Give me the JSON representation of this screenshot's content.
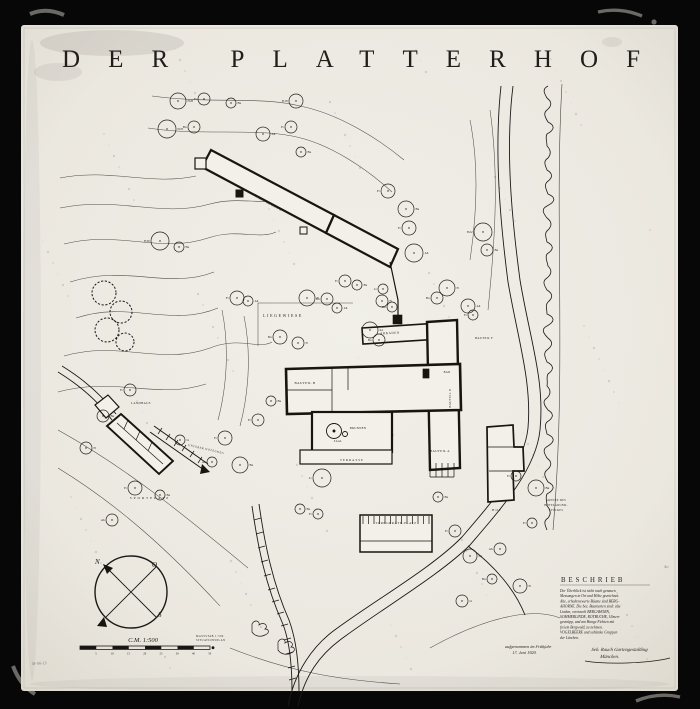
{
  "artwork": {
    "title": "DER PLATTERHOF",
    "corner_mark": "M-06-13",
    "plate_mark": "4a"
  },
  "compass": {
    "letters": {
      "n": "N",
      "o": "O",
      "s": "S"
    }
  },
  "scale_bar": {
    "label": "C.M. 1:500",
    "ticks": [
      "5",
      "10",
      "15",
      "20",
      "25",
      "30",
      "40",
      "50"
    ]
  },
  "beschrieb": {
    "heading": "BESCHRIEB",
    "lines": [
      "Der Überblick ist nicht nach genauen",
      "Messungen in Ort und Höhe gezeichnet.",
      "Alte, erhaltenswerte Bäume sind BERG-",
      "AHORNE. Die bez. Baumarten sind: alte",
      "Linden, vereinzelt BERGAHORN,",
      "SOMMERLINDE, ROTBUCHE, Ulmen-",
      "gestrüpp, und am Hange Fichten mit",
      "freiem Bergwald, zu nehmen.",
      "VOGELBEERE und schlanke Gruppen",
      "der Lärchen."
    ]
  },
  "notes": {
    "legend_small_lines": [
      "MASSSTAB 1:500",
      "SITUATIONSPLAN"
    ],
    "survey_note_lines": [
      "aufgenommen im Frühjahr",
      "17. Juni 1920."
    ],
    "signature_lines": [
      "Seb. Rauch Gartengestaltung",
      "München."
    ]
  },
  "plan_labels": [
    {
      "text": "LIEGEWIESE",
      "x": 283,
      "y": 317,
      "size": 4.0,
      "rot": 0,
      "ls": 1.6
    },
    {
      "text": "ARKADEN",
      "x": 390,
      "y": 334,
      "size": 3.2,
      "rot": -2,
      "ls": 0.6
    },
    {
      "text": "BAUTEIL B",
      "x": 305,
      "y": 384,
      "size": 3.4,
      "rot": 0,
      "ls": 0.4
    },
    {
      "text": "BAUTEIL A",
      "x": 440,
      "y": 452,
      "size": 3.2,
      "rot": 0,
      "ls": 0.4
    },
    {
      "text": "BAUTEIL D",
      "x": 451,
      "y": 398,
      "size": 3.0,
      "rot": -90,
      "ls": 0.4
    },
    {
      "text": "BAUTEIL F",
      "x": 484,
      "y": 339,
      "size": 3.0,
      "rot": 0,
      "ls": 0.3
    },
    {
      "text": "BRUNNEN",
      "x": 358,
      "y": 429,
      "size": 3.0,
      "rot": 0,
      "ls": 0.3
    },
    {
      "text": "TERRASSE",
      "x": 352,
      "y": 461,
      "size": 3.2,
      "rot": 0,
      "ls": 1.0
    },
    {
      "text": "TURNGERÄTE-PLATZ",
      "x": 396,
      "y": 524,
      "size": 3.2,
      "rot": 0,
      "ls": 0.6
    },
    {
      "text": "WANDELGANG",
      "x": 268,
      "y": 204,
      "size": 3.2,
      "rot": 28,
      "ls": 0.8
    },
    {
      "text": "SPORTPLATZ",
      "x": 150,
      "y": 499,
      "size": 3.4,
      "rot": 0,
      "ls": 2.0
    },
    {
      "text": "LANDHAUS",
      "x": 141,
      "y": 404,
      "size": 3.0,
      "rot": 0,
      "ls": 0.4
    },
    {
      "text": "UNTERER HOTELWEG",
      "x": 206,
      "y": 450,
      "size": 2.8,
      "rot": 13,
      "ls": 0.5
    },
    {
      "text": "GRENZE DES",
      "x": 556,
      "y": 501,
      "size": 2.8,
      "rot": 0,
      "ls": 0.3
    },
    {
      "text": "HOTELGRUND-",
      "x": 556,
      "y": 506,
      "size": 2.8,
      "rot": 0,
      "ls": 0.3
    },
    {
      "text": "STÜCKES",
      "x": 556,
      "y": 511,
      "size": 2.8,
      "rot": 0,
      "ls": 0.3
    },
    {
      "text": "HOF",
      "x": 497,
      "y": 511,
      "size": 3.2,
      "rot": 0,
      "ls": 1.2
    },
    {
      "text": "SAAL",
      "x": 338,
      "y": 442,
      "size": 2.8,
      "rot": 0,
      "ls": 0.3
    },
    {
      "text": "BAD",
      "x": 447,
      "y": 373,
      "size": 2.8,
      "rot": 0,
      "ls": 0.3
    }
  ],
  "trees": [
    [
      178,
      101,
      8,
      "Fi20"
    ],
    [
      204,
      99,
      6,
      "Fi"
    ],
    [
      231,
      103,
      5,
      "Bu"
    ],
    [
      296,
      101,
      7,
      "Fi18"
    ],
    [
      167,
      129,
      9,
      "Fi25"
    ],
    [
      194,
      127,
      6,
      "Bu"
    ],
    [
      263,
      134,
      7,
      "Ah"
    ],
    [
      291,
      127,
      6,
      "Fi"
    ],
    [
      301,
      152,
      5,
      "Bu"
    ],
    [
      388,
      191,
      7,
      "Fi"
    ],
    [
      406,
      209,
      8,
      "Bu"
    ],
    [
      409,
      228,
      7,
      "Fi"
    ],
    [
      414,
      253,
      9,
      "Ah"
    ],
    [
      483,
      232,
      9,
      "Fi22"
    ],
    [
      487,
      250,
      6,
      "Bu"
    ],
    [
      345,
      281,
      6,
      "Fi"
    ],
    [
      357,
      285,
      5,
      "Bu"
    ],
    [
      383,
      289,
      5,
      "Li"
    ],
    [
      382,
      301,
      6,
      "Fi"
    ],
    [
      392,
      307,
      5,
      "Bu"
    ],
    [
      370,
      330,
      8,
      "Ka"
    ],
    [
      379,
      340,
      6,
      "Bu"
    ],
    [
      447,
      288,
      8,
      "Fi"
    ],
    [
      437,
      298,
      6,
      "Bu"
    ],
    [
      468,
      306,
      7,
      "Ah"
    ],
    [
      473,
      315,
      5,
      "Fi"
    ],
    [
      307,
      298,
      8,
      "Fi"
    ],
    [
      327,
      299,
      6,
      "Bu"
    ],
    [
      337,
      308,
      5,
      "Ah"
    ],
    [
      280,
      337,
      7,
      "Bu"
    ],
    [
      298,
      343,
      6,
      "Fi"
    ],
    [
      160,
      241,
      9,
      "Fi30"
    ],
    [
      179,
      247,
      5,
      "Bu"
    ],
    [
      237,
      298,
      7,
      "Fi"
    ],
    [
      248,
      301,
      5,
      "Ah"
    ],
    [
      130,
      390,
      6,
      "Fi"
    ],
    [
      103,
      416,
      6,
      "Bu"
    ],
    [
      225,
      438,
      7,
      "Fi"
    ],
    [
      240,
      465,
      8,
      "Bu"
    ],
    [
      212,
      462,
      5,
      "Ah"
    ],
    [
      180,
      440,
      5,
      "Li"
    ],
    [
      135,
      488,
      7,
      "Fi"
    ],
    [
      160,
      495,
      5,
      "Bu"
    ],
    [
      112,
      520,
      6,
      "Ah"
    ],
    [
      86,
      448,
      6,
      "Fi"
    ],
    [
      258,
      420,
      6,
      "Fi"
    ],
    [
      271,
      401,
      5,
      "Bu"
    ],
    [
      322,
      478,
      9,
      "Li"
    ],
    [
      300,
      509,
      5,
      "Bu"
    ],
    [
      318,
      514,
      5,
      "Fi"
    ],
    [
      438,
      497,
      5,
      "Bu"
    ],
    [
      455,
      531,
      6,
      "Fi"
    ],
    [
      470,
      556,
      7,
      "Bu"
    ],
    [
      500,
      549,
      6,
      "Ah"
    ],
    [
      520,
      586,
      7,
      "Fi"
    ],
    [
      492,
      579,
      5,
      "Bu"
    ],
    [
      462,
      601,
      6,
      "Li"
    ],
    [
      532,
      523,
      5,
      "Fi"
    ],
    [
      536,
      488,
      8,
      "Bu"
    ],
    [
      516,
      476,
      5,
      "Fi"
    ]
  ],
  "colors": {
    "paper": "#edebe3",
    "ink": "#1c1a18",
    "frame": "#050505",
    "faded_ink": "#4a463f"
  }
}
